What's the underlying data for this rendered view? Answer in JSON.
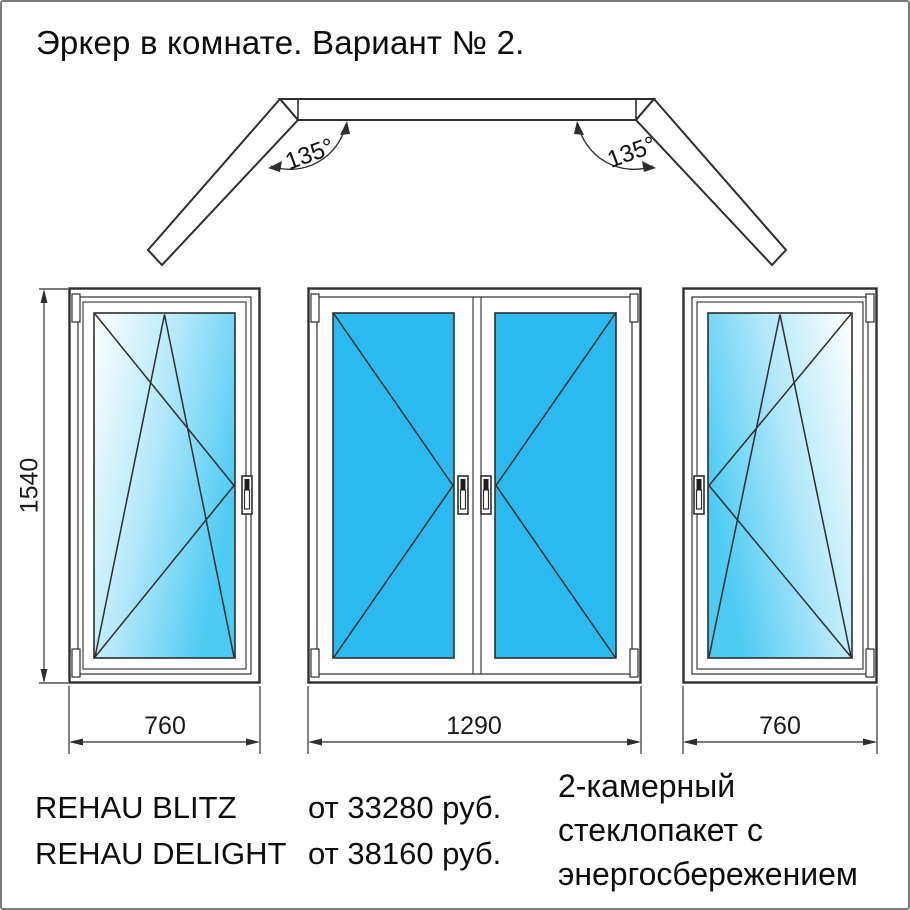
{
  "title": "Эркер в комнате. Вариант № 2.",
  "plan": {
    "left_angle": "135°",
    "right_angle": "135°"
  },
  "dimensions": {
    "height": "1540",
    "left_width": "760",
    "center_width": "1290",
    "right_width": "760"
  },
  "pricing": {
    "rows": [
      {
        "product": "REHAU BLITZ",
        "price": "от 33280 руб."
      },
      {
        "product": "REHAU DELIGHT",
        "price": "от 38160 руб."
      }
    ]
  },
  "glazing": {
    "lines": [
      "2-камерный",
      "стеклопакет с",
      "энергосбережением"
    ]
  },
  "colors": {
    "glass_cyan": "#2ABAF0",
    "line": "#2E2E2E"
  }
}
